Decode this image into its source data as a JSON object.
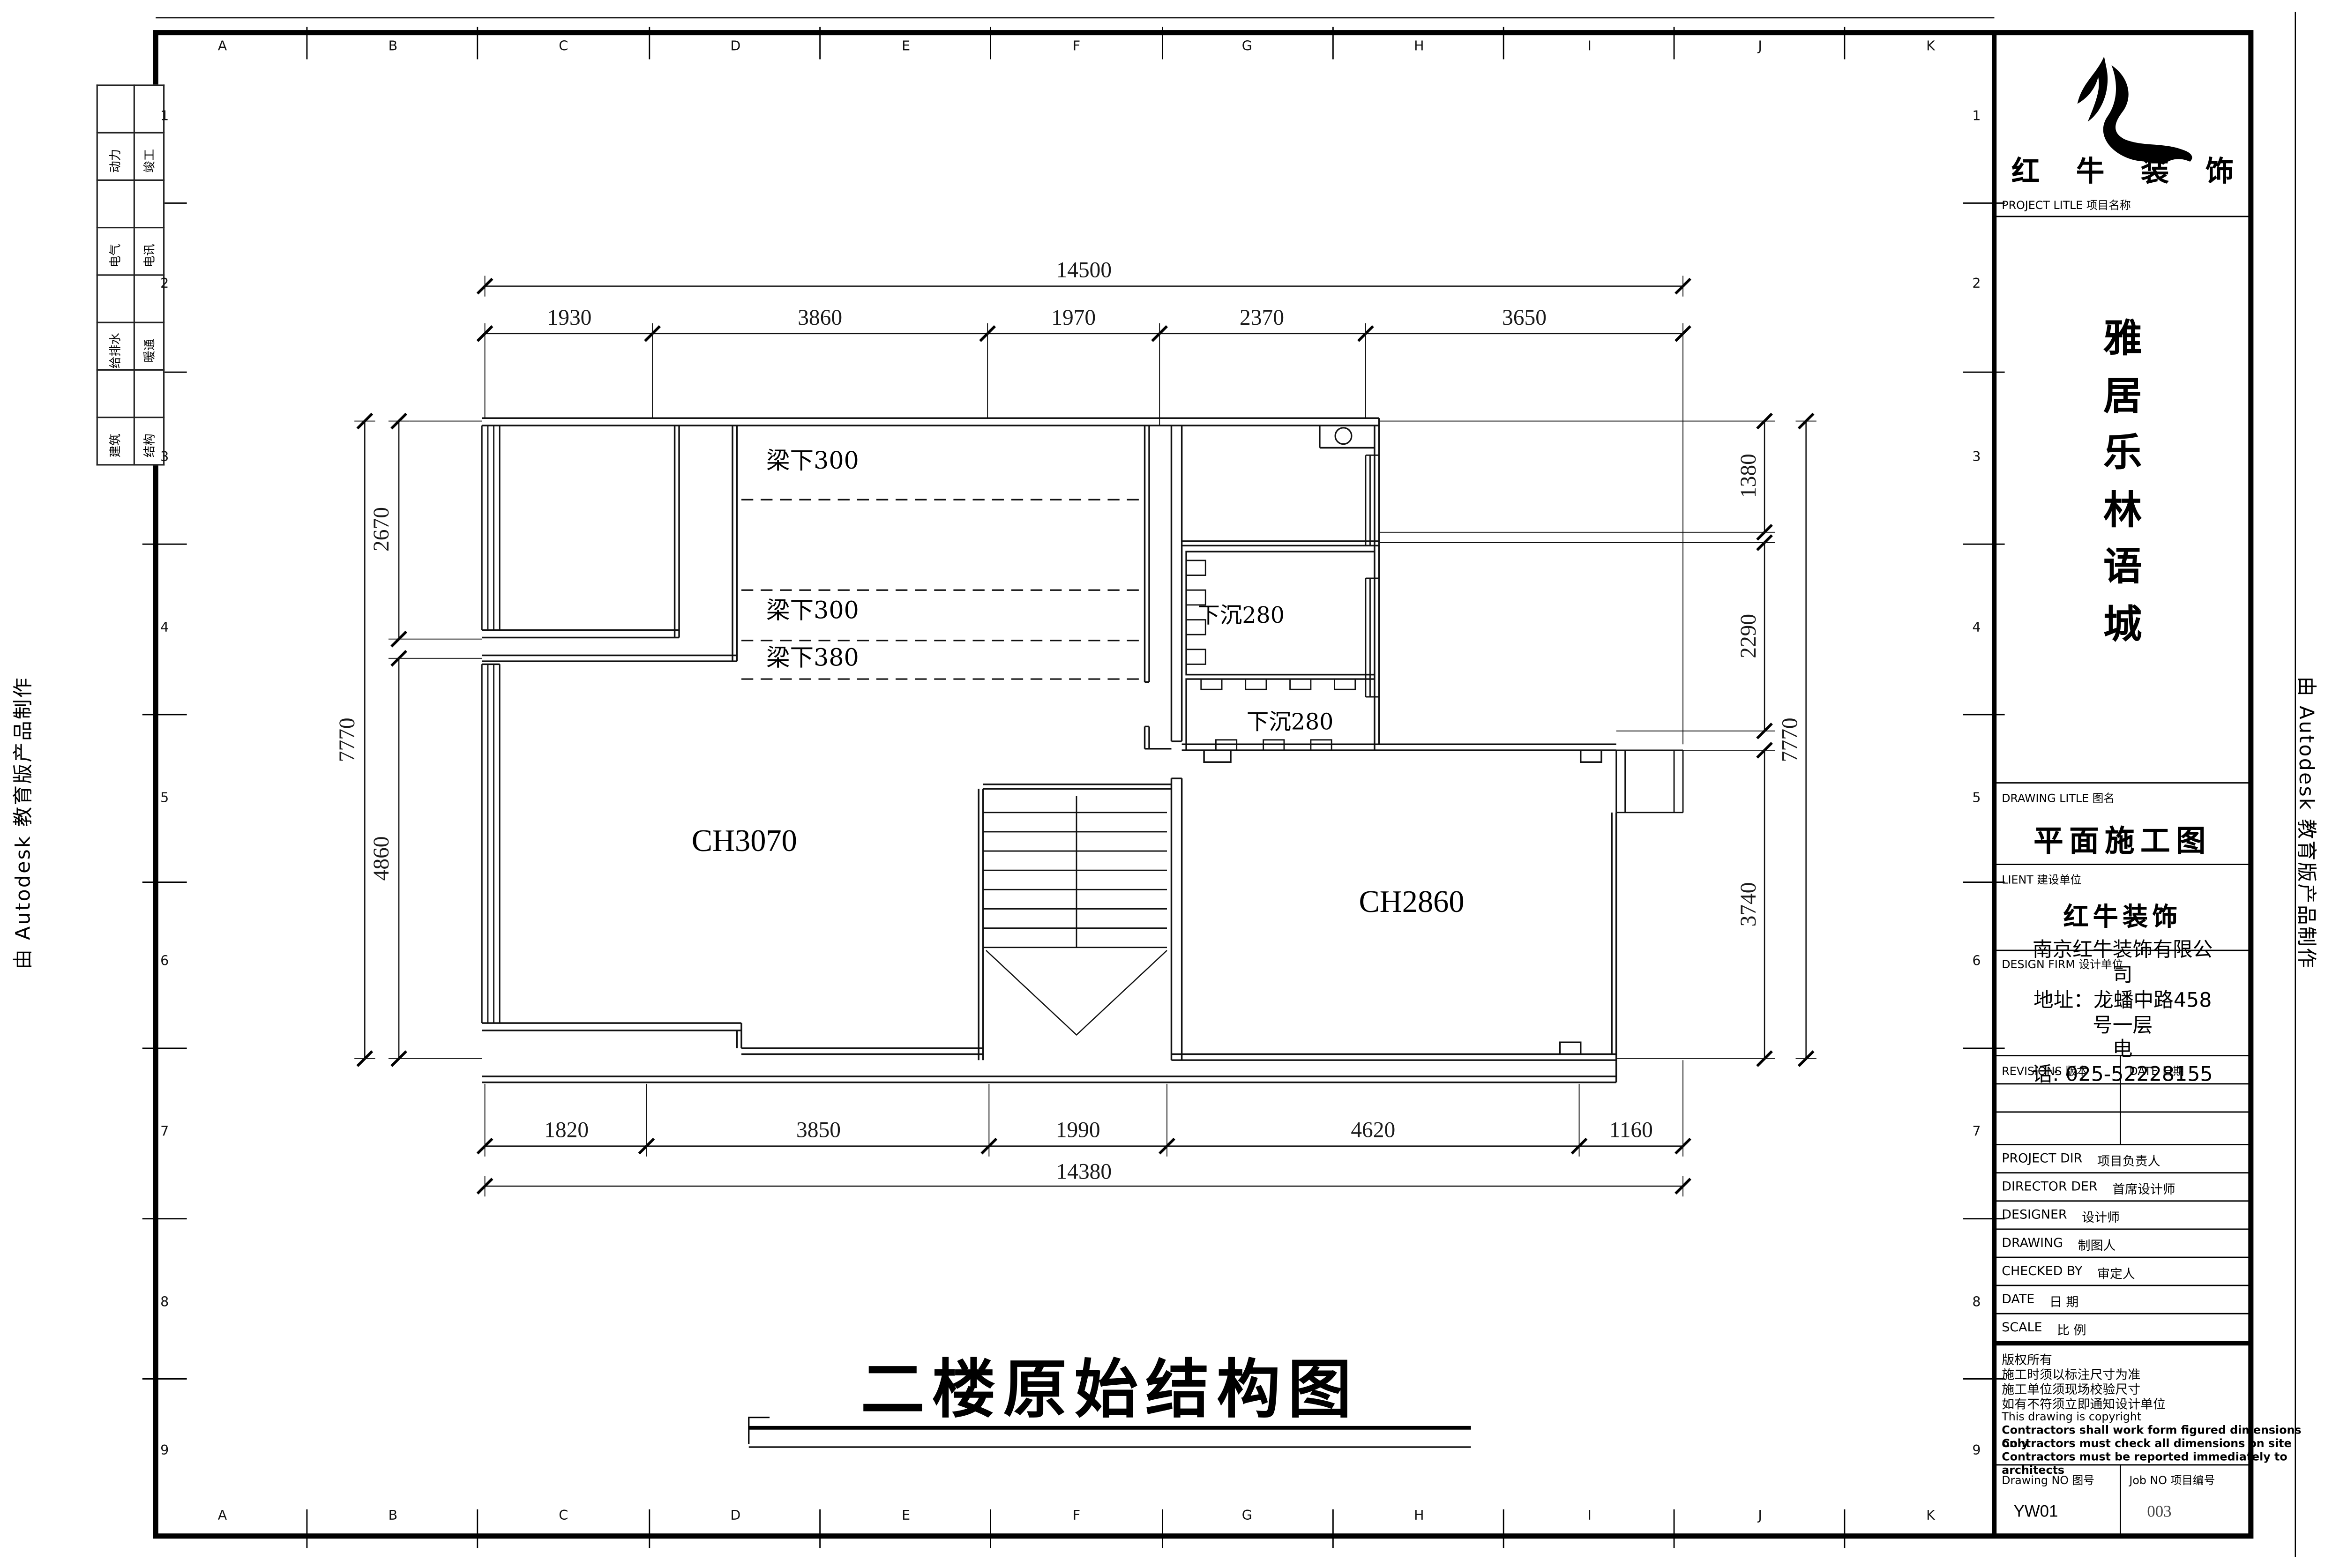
{
  "sheet": {
    "edge_stamp": "由 Autodesk 教育版产品制作",
    "grid_letters": [
      "A",
      "B",
      "C",
      "D",
      "E",
      "F",
      "G",
      "H",
      "I",
      "J",
      "K"
    ],
    "grid_numbers": [
      "1",
      "2",
      "3",
      "4",
      "5",
      "6",
      "7",
      "8",
      "9"
    ]
  },
  "discipline_tabs": {
    "rows": [
      {
        "c1": "动力",
        "c2": "竣工"
      },
      {
        "c1": "电气",
        "c2": "电讯"
      },
      {
        "c1": "给排水",
        "c2": "暖通"
      },
      {
        "c1": "建筑",
        "c2": "结构"
      }
    ]
  },
  "plan": {
    "drawing_title": "二楼原始结构图",
    "room_labels": [
      "CH3070",
      "CH2860"
    ],
    "beam_notes": [
      "梁下300",
      "梁下300",
      "梁下380"
    ],
    "sunken_notes": [
      "下沉280",
      "下沉280"
    ],
    "dims": {
      "top_total": "14500",
      "top_segments": [
        "1930",
        "3860",
        "1970",
        "2370",
        "3650"
      ],
      "bottom_segments": [
        "1820",
        "3850",
        "1990",
        "4620",
        "1160"
      ],
      "bottom_total": "14380",
      "left_outer": "7770",
      "left_upper": "2670",
      "left_lower": "4860",
      "right_top": "1380",
      "right_mid": "2290",
      "right_bottom": "3740",
      "right_outer": "7770"
    }
  },
  "title_block": {
    "logo_text": "红 牛 装 饰",
    "project_title_label": "PROJECT LITLE 项目名称",
    "project_name_chars": [
      "雅",
      "居",
      "乐",
      "林",
      "语",
      "城"
    ],
    "drawing_title_label": "DRAWING LITLE 图名",
    "drawing_title": "平面施工图",
    "client_label": "LIENT 建设单位",
    "client_name": "红牛装饰",
    "firm_line1": "南京红牛装饰有限公",
    "firm_line2": "司",
    "design_firm_label": "DESIGN FIRM 设计单位",
    "address_line1": "地址：龙蟠中路458",
    "address_line2": "号一层",
    "phone_line1": "电",
    "phone_line2": "话: 025-52228155",
    "revisions_label": "REVISIONS 版本",
    "date_col_label": "DATE 日期",
    "staff_rows": [
      {
        "en": "PROJECT DIR",
        "zh": "项目负责人"
      },
      {
        "en": "DIRECTOR DER",
        "zh": "首席设计师"
      },
      {
        "en": "DESIGNER",
        "zh": "设计师"
      },
      {
        "en": "DRAWING",
        "zh": "制图人"
      },
      {
        "en": "CHECKED BY",
        "zh": "审定人"
      },
      {
        "en": "DATE",
        "zh": "日 期"
      },
      {
        "en": "SCALE",
        "zh": "比 例"
      }
    ],
    "notes": [
      "版权所有",
      "施工时须以标注尺寸为准",
      "施工单位须现场校验尺寸",
      "如有不符须立即通知设计单位",
      "This drawing is copyright",
      "Contractors shall work form figured dimensions only",
      "Contractors must check all dimensions on site",
      "Contractors must be reported immediately to architects"
    ],
    "drawing_no_label": "Drawing NO 图号",
    "drawing_no": "YW01",
    "job_no_label": "Job NO 项目编号",
    "job_no": "003"
  }
}
